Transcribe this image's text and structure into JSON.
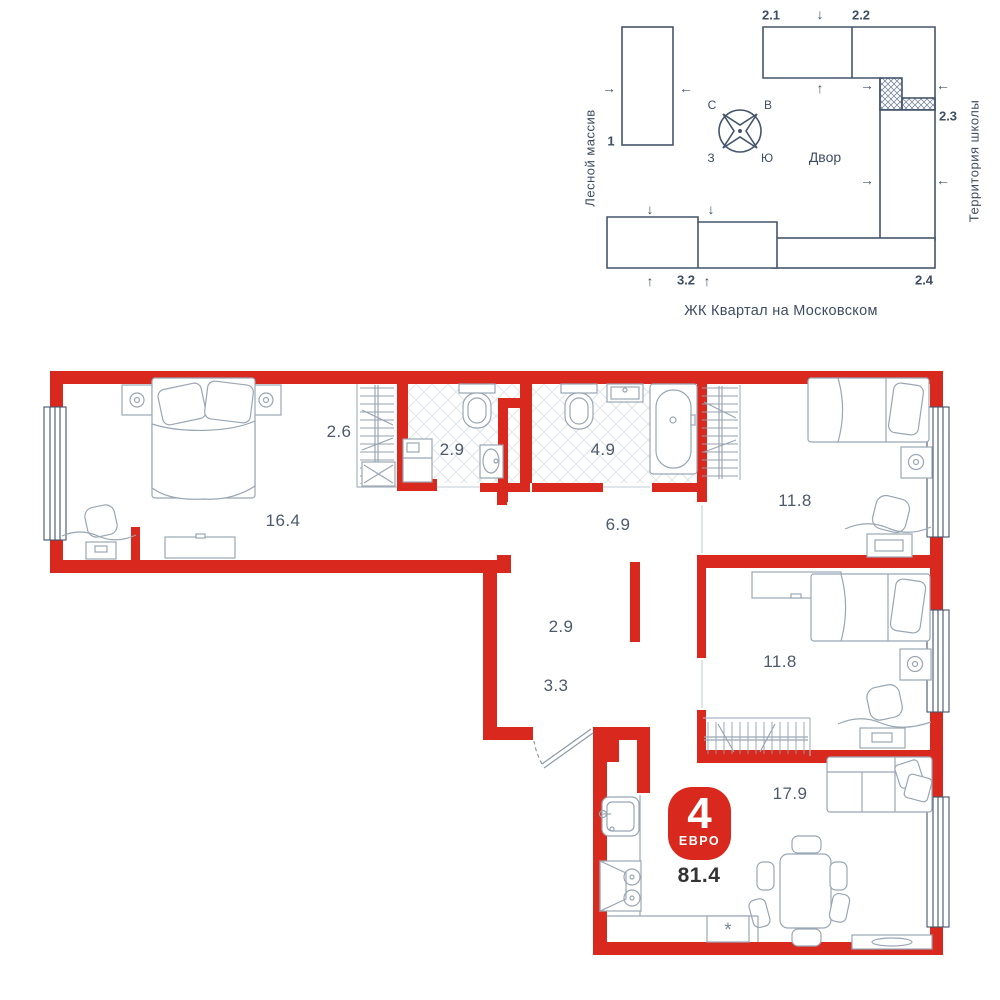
{
  "site_plan": {
    "left_area_label": "Лесной массив",
    "right_area_label": "Территория школы",
    "caption": "ЖК Квартал на Московском",
    "courtyard_label": "Двор",
    "compass": {
      "n": "С",
      "e": "В",
      "w": "З",
      "s": "Ю"
    },
    "building_labels": {
      "b1": "1",
      "b2_1": "2.1",
      "b2_2": "2.2",
      "b2_3": "2.3",
      "b2_4": "2.4",
      "b3_2": "3.2"
    },
    "arrow_glyphs": {
      "up": "↑",
      "down": "↓",
      "left": "←",
      "right": "→"
    }
  },
  "floor_plan": {
    "rooms": [
      {
        "name": "bedroom-master",
        "area": "16.4"
      },
      {
        "name": "wardrobe-master",
        "area": "2.6"
      },
      {
        "name": "bathroom-ensuite",
        "area": "2.9"
      },
      {
        "name": "bathroom",
        "area": "4.9"
      },
      {
        "name": "corridor",
        "area": "6.9"
      },
      {
        "name": "bedroom-2",
        "area": "11.8"
      },
      {
        "name": "bedroom-3",
        "area": "11.8"
      },
      {
        "name": "wardrobe-hall",
        "area": "2.9"
      },
      {
        "name": "hallway",
        "area": "3.3"
      },
      {
        "name": "kitchen-living",
        "area": "17.9"
      }
    ],
    "badge": {
      "rooms_count": "4",
      "type_label": "ЕВРО",
      "total_area": "81.4"
    },
    "appliance_symbol": "*"
  },
  "colors": {
    "wall_red": "#d9291f",
    "line_navy": "#44556b",
    "furniture": "#99a6b3",
    "tile": "#e0e5ea",
    "text": "#4d5a6b"
  }
}
